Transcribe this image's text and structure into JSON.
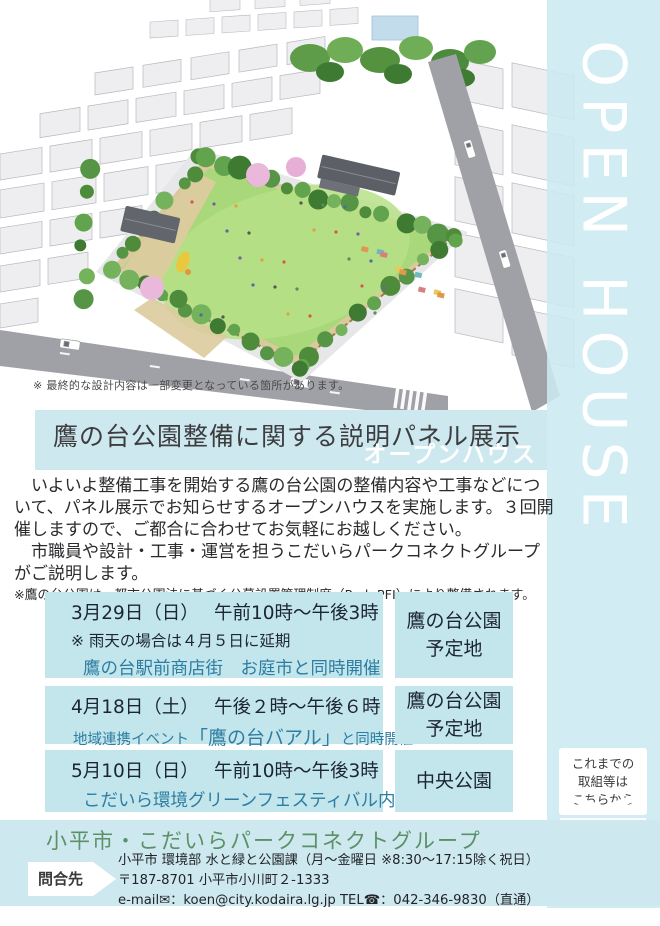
{
  "hero": {
    "design_note": "※ 最終的な設計内容は一部変更となっている箇所があります。"
  },
  "side_banner": {
    "vertical_text": "OPEN HOUSE",
    "link_note_lines": [
      "これまでの",
      "取組等は",
      "こちらから"
    ]
  },
  "title_band": {
    "title": "鷹の台公園整備に関する説明パネル展示",
    "subtitle": "オープンハウス"
  },
  "intro": {
    "paragraph1": "いよいよ整備工事を開始する鷹の台公園の整備内容や工事などについて、パネル展示でお知らせするオープンハウスを実施します。３回開催しますので、ご都合に合わせてお気軽にお越しください。",
    "paragraph2": "市職員や設計・工事・運営を担うこだいらパークコネクトグループがご説明します。",
    "note": "※鷹の台公園は、都市公園法に基づく公募設置管理制度（Park-PFI）により整備されます。"
  },
  "schedule": {
    "rows": [
      {
        "date_time": "3月29日（日）　 午前10時～午後3時",
        "note": "※ 雨天の場合は４月５日に延期",
        "event": "鷹の台駅前商店街　お庭市と同時開催",
        "location_line1": "鷹の台公園",
        "location_line2": "予定地"
      },
      {
        "date_time": "4月18日（土）　 午後２時～午後６時",
        "event_prefix": "地域連携イベント",
        "event_emphasis": "「鷹の台バアル」",
        "event_suffix": "と同時開催",
        "location_line1": "鷹の台公園",
        "location_line2": "予定地"
      },
      {
        "date_time": "5月10日（日）　 午前10時～午後3時",
        "event": "こだいら環境グリーンフェスティバル内",
        "location_line1": "中央公園",
        "location_line2": ""
      }
    ]
  },
  "footer": {
    "organization": "小平市・こだいらパークコネクトグループ",
    "contact_label": "問合先",
    "department_line": "小平市 環境部 水と緑と公園課（月～金曜日 ※8:30～17:15除く祝日）",
    "address_line": "〒187-8701 小平市小川町２-1333",
    "email_phone_line": "e-mail✉：koen@city.kodaira.lg.jp TEL☎：042-346-9830（直通）"
  },
  "colors": {
    "band_cyan": "#cde9ef",
    "box_cyan": "#c3e6ed",
    "accent_teal": "#2e7da1",
    "org_green": "#5c9066"
  }
}
